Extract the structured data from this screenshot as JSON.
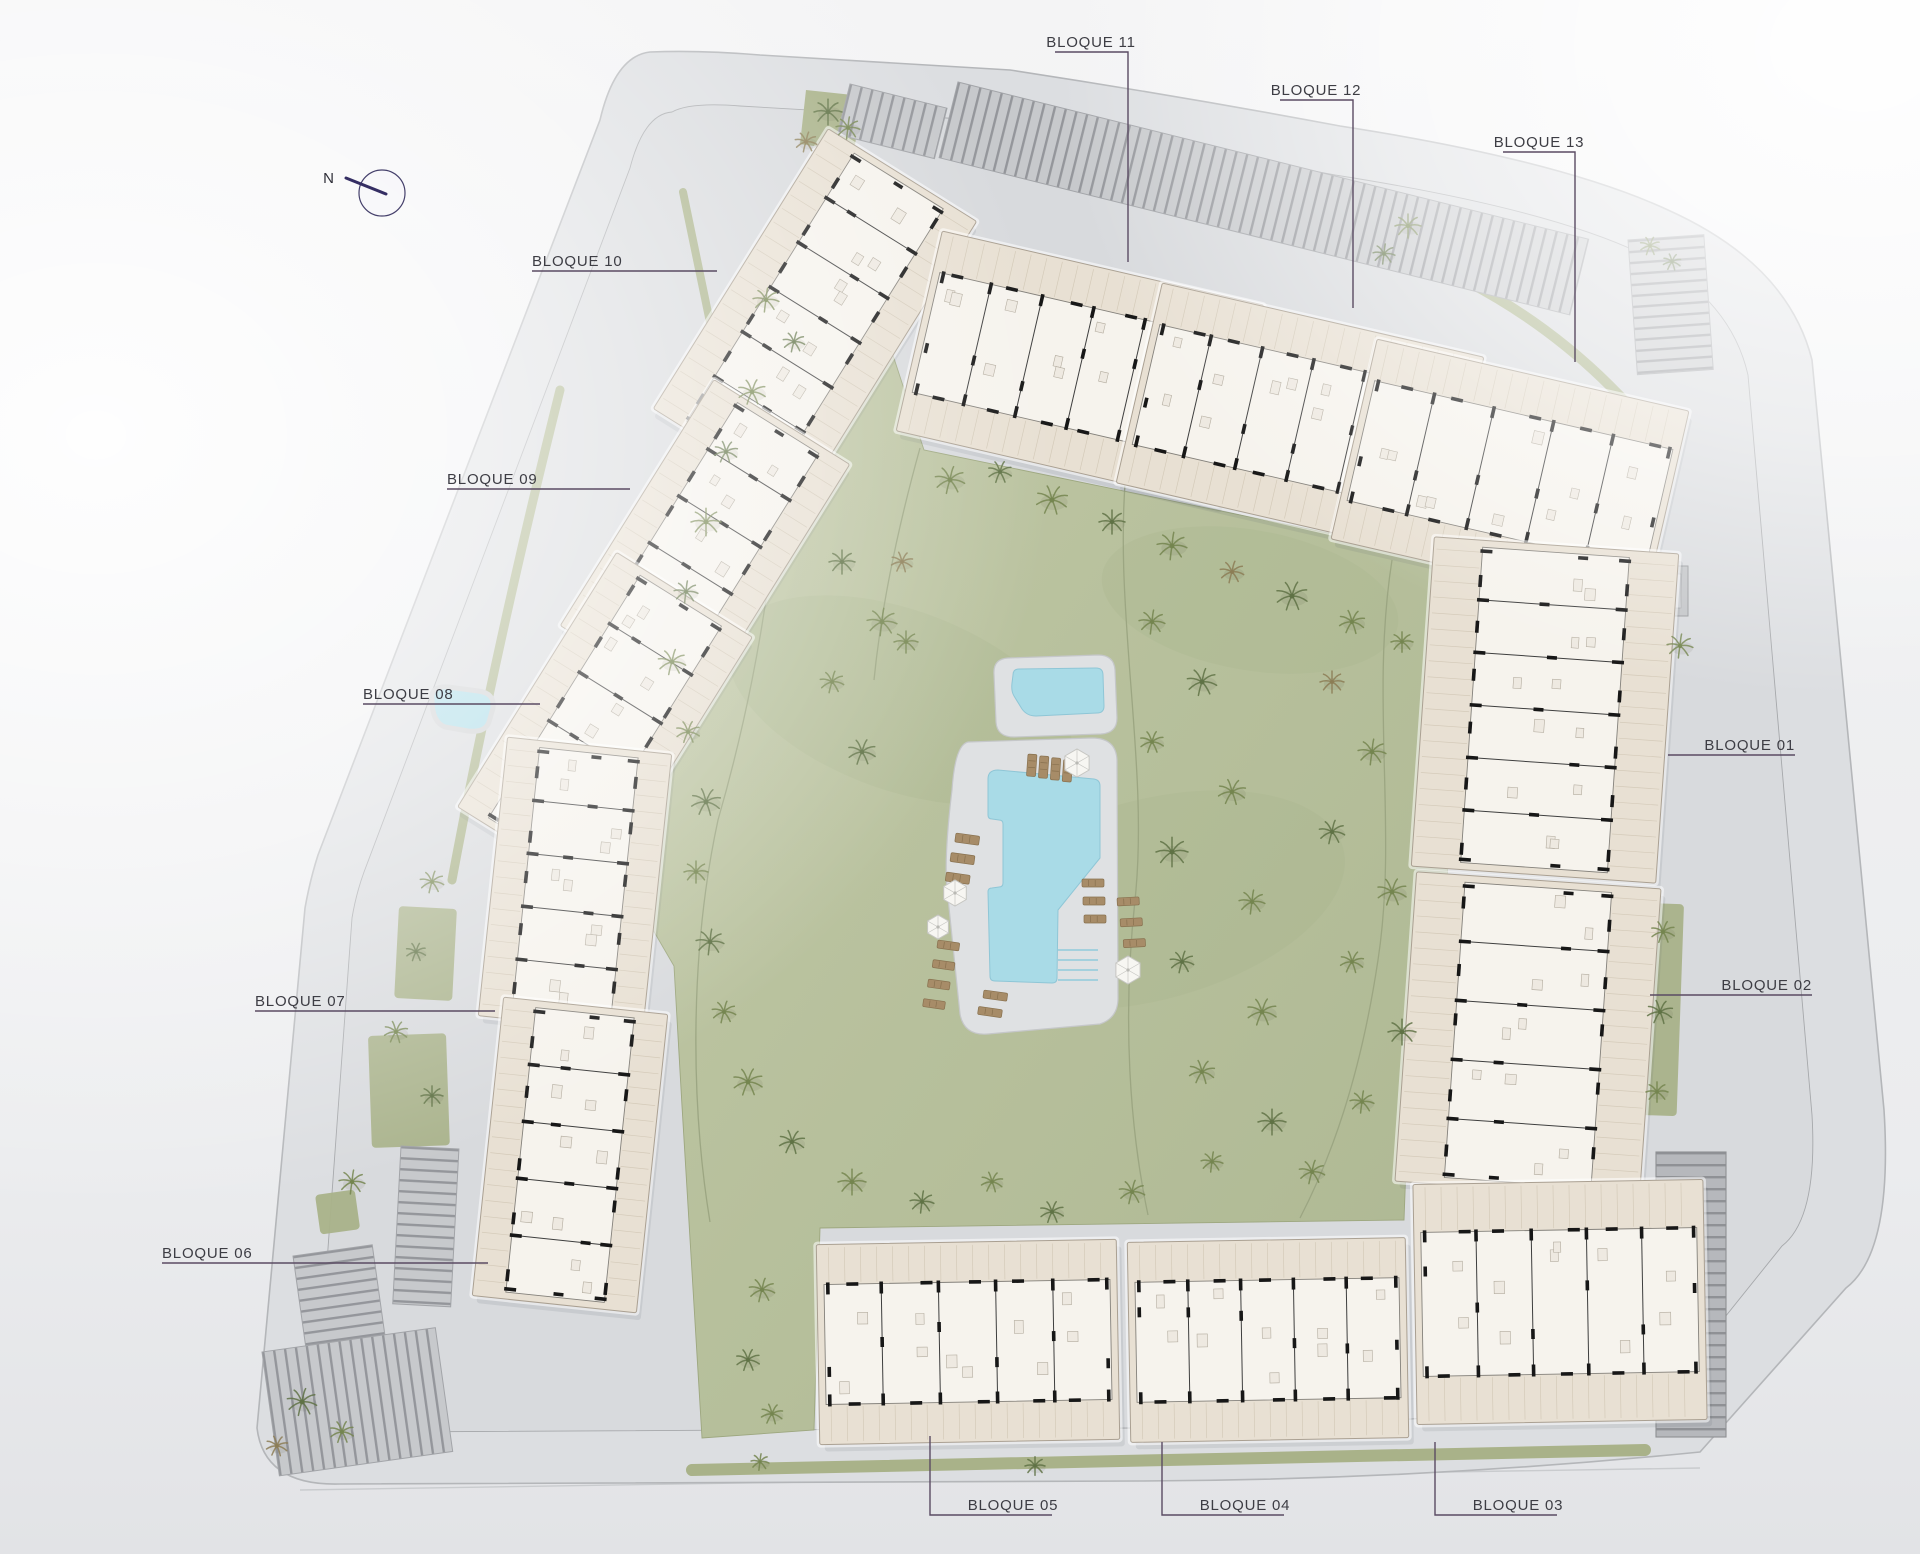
{
  "meta": {
    "type": "residential-site-plan",
    "blocks_total": 13
  },
  "compass": {
    "label": "N",
    "cx": 382,
    "cy": 193,
    "r": 23,
    "needle": [
      346,
      178,
      386,
      194
    ],
    "label_x": 334,
    "label_y": 183
  },
  "colors": {
    "bg_top": "#f4f4f5",
    "bg_bottom": "#e2e3e6",
    "road": "#dcdee1",
    "road_edge": "#b4b6b9",
    "parcel": "#d8dadd",
    "parcel_edge": "#a6a8ab",
    "lawn1": "#c2c9a8",
    "lawn2": "#aeb893",
    "lawn_edge": "#9da77f",
    "lawn_path": "#99a37f",
    "water": "#a9dbe7",
    "water_edge": "#8fc6d6",
    "deck": "#dfe1e3",
    "deck_edge": "#c5c7c9",
    "slab": "#e8e0d3",
    "slab_edge": "#aaa092",
    "core": "#f6f3ed",
    "core_edge": "#84817b",
    "wall": "#171717",
    "divider": "#3e3e3e",
    "furn": "#b3ac9f",
    "hatch": "#d4cab9",
    "stripe_bg": "#c7c9cc",
    "stripe": "#94969b",
    "ramp_bg": "#b6b8bc",
    "ramp_line": "#8f9195",
    "green_strip": "#a9b289",
    "tree_g": "#74854f",
    "tree_d": "#5f7245",
    "tree_b": "#8c7d55",
    "leader": "#5a4b63",
    "label_text": "#3d3d44",
    "lounger": "#a78c68",
    "lounger_edge": "#88714f",
    "umbrella": "#f7f6f2",
    "umbrella_edge": "#c6c6c2",
    "compass_ring": "#45406b",
    "compass_needle": "#352e63"
  },
  "site": {
    "outer_path": "M650,52 Q700,50 760,55 L1010,70 Q1180,96 1340,126 Q1560,160 1668,210 Q1788,264 1812,360 L1884,1110 Q1893,1252 1846,1288 L1700,1452 Q1420,1480 1140,1481 L340,1484 Q264,1486 257,1428 L305,908 Q310,880 318,855 L600,120 Q615,56 650,52 Z",
    "inner_path": "M672,112 Q690,102 740,106 L1015,122 Q1180,146 1335,175 Q1545,208 1640,253 Q1730,296 1748,375 L1812,1115 Q1818,1218 1782,1246 L1660,1398 Q1408,1426 1136,1428 L382,1432 Q322,1434 318,1386 L352,918 Q356,894 364,872 L630,168 Q644,114 672,112 Z",
    "lawn_path": "M762,250 L808,242 Q850,290 888,340 L924,450 L1450,558 Q1460,568 1458,592 L1444,964 L1412,1006 L1404,1220 L820,1228 L814,1430 L702,1438 L682,1106 L674,966 L624,880 L662,762 L702,642 L742,522 L792,402 L782,302 Z",
    "bottom_edge_line": "M300,1490 L1700,1468"
  },
  "lawn_paths": [
    "M766,262 C800,420 770,640 718,820 C690,950 690,1100 710,1222",
    "M1128,452 C1110,600 1150,760 1135,900 C1122,1020 1130,1130 1148,1215",
    "M1392,560 C1370,700 1398,830 1378,960 C1360,1080 1330,1160 1300,1218",
    "M920,448 C900,520 882,600 874,680"
  ],
  "mounds": [
    [
      900,
      700,
      180,
      90,
      20
    ],
    [
      1150,
      900,
      200,
      100,
      -15
    ],
    [
      1250,
      600,
      150,
      70,
      10
    ]
  ],
  "labels": [
    {
      "id": "b10",
      "text": "BLOQUE 10",
      "tx": 532,
      "ty": 266,
      "anchor": "start",
      "line": [
        [
          532,
          271
        ],
        [
          717,
          271
        ]
      ]
    },
    {
      "id": "b09",
      "text": "BLOQUE 09",
      "tx": 447,
      "ty": 484,
      "anchor": "start",
      "line": [
        [
          447,
          489
        ],
        [
          630,
          489
        ]
      ]
    },
    {
      "id": "b08",
      "text": "BLOQUE 08",
      "tx": 363,
      "ty": 699,
      "anchor": "start",
      "line": [
        [
          363,
          704
        ],
        [
          540,
          704
        ]
      ]
    },
    {
      "id": "b07",
      "text": "BLOQUE 07",
      "tx": 255,
      "ty": 1006,
      "anchor": "start",
      "line": [
        [
          255,
          1011
        ],
        [
          495,
          1011
        ]
      ]
    },
    {
      "id": "b06",
      "text": "BLOQUE 06",
      "tx": 162,
      "ty": 1258,
      "anchor": "start",
      "line": [
        [
          162,
          1263
        ],
        [
          488,
          1263
        ]
      ]
    },
    {
      "id": "b01",
      "text": "BLOQUE 01",
      "tx": 1795,
      "ty": 750,
      "anchor": "end",
      "line": [
        [
          1668,
          755
        ],
        [
          1795,
          755
        ]
      ]
    },
    {
      "id": "b02",
      "text": "BLOQUE 02",
      "tx": 1812,
      "ty": 990,
      "anchor": "end",
      "line": [
        [
          1650,
          995
        ],
        [
          1812,
          995
        ]
      ]
    },
    {
      "id": "b11",
      "text": "BLOQUE 11",
      "tx": 1091,
      "ty": 47,
      "anchor": "middle",
      "line": [
        [
          1055,
          52
        ],
        [
          1128,
          52
        ],
        [
          1128,
          262
        ]
      ]
    },
    {
      "id": "b12",
      "text": "BLOQUE 12",
      "tx": 1316,
      "ty": 95,
      "anchor": "middle",
      "line": [
        [
          1280,
          100
        ],
        [
          1353,
          100
        ],
        [
          1353,
          308
        ]
      ]
    },
    {
      "id": "b13",
      "text": "BLOQUE 13",
      "tx": 1539,
      "ty": 147,
      "anchor": "middle",
      "line": [
        [
          1503,
          152
        ],
        [
          1575,
          152
        ],
        [
          1575,
          362
        ]
      ]
    },
    {
      "id": "b05",
      "text": "BLOQUE 05",
      "tx": 1013,
      "ty": 1510,
      "anchor": "middle",
      "line": [
        [
          930,
          1436
        ],
        [
          930,
          1515
        ],
        [
          1052,
          1515
        ]
      ]
    },
    {
      "id": "b04",
      "text": "BLOQUE 04",
      "tx": 1245,
      "ty": 1510,
      "anchor": "middle",
      "line": [
        [
          1162,
          1442
        ],
        [
          1162,
          1515
        ],
        [
          1284,
          1515
        ]
      ]
    },
    {
      "id": "b03",
      "text": "BLOQUE 03",
      "tx": 1518,
      "ty": 1510,
      "anchor": "middle",
      "line": [
        [
          1435,
          1442
        ],
        [
          1435,
          1515
        ],
        [
          1557,
          1515
        ]
      ]
    }
  ],
  "blocks": [
    {
      "id": "10",
      "cx": 815,
      "cy": 315,
      "w": 175,
      "h": 330,
      "rot": 32
    },
    {
      "id": "09",
      "cx": 705,
      "cy": 545,
      "w": 160,
      "h": 290,
      "rot": 32
    },
    {
      "id": "08",
      "cx": 605,
      "cy": 722,
      "w": 160,
      "h": 300,
      "rot": 32
    },
    {
      "id": "07",
      "cx": 575,
      "cy": 885,
      "w": 165,
      "h": 280,
      "rot": 6
    },
    {
      "id": "06",
      "cx": 570,
      "cy": 1155,
      "w": 165,
      "h": 300,
      "rot": 6
    },
    {
      "id": "11",
      "cx": 1080,
      "cy": 368,
      "w": 330,
      "h": 205,
      "rot": 13
    },
    {
      "id": "12",
      "cx": 1300,
      "cy": 420,
      "w": 330,
      "h": 205,
      "rot": 13
    },
    {
      "id": "13",
      "cx": 1510,
      "cy": 475,
      "w": 320,
      "h": 205,
      "rot": 13
    },
    {
      "id": "01",
      "cx": 1545,
      "cy": 710,
      "w": 245,
      "h": 330,
      "rot": 4
    },
    {
      "id": "02",
      "cx": 1528,
      "cy": 1035,
      "w": 245,
      "h": 310,
      "rot": 4
    },
    {
      "id": "05",
      "cx": 968,
      "cy": 1342,
      "w": 300,
      "h": 200,
      "rot": -1
    },
    {
      "id": "04",
      "cx": 1268,
      "cy": 1340,
      "w": 278,
      "h": 200,
      "rot": -1
    },
    {
      "id": "03",
      "cx": 1560,
      "cy": 1302,
      "w": 290,
      "h": 240,
      "rot": -1
    }
  ],
  "parking": [
    {
      "x": 958,
      "y": 82,
      "rot": 14,
      "w": 650,
      "h": 78,
      "o": "v"
    },
    {
      "x": 850,
      "y": 84,
      "rot": 14,
      "w": 100,
      "h": 52,
      "o": "v"
    },
    {
      "x": 1628,
      "y": 240,
      "rot": -4,
      "w": 76,
      "h": 135,
      "o": "h"
    },
    {
      "x": 401,
      "y": 1146,
      "rot": 3,
      "w": 58,
      "h": 158,
      "o": "h"
    },
    {
      "x": 293,
      "y": 1256,
      "rot": -8,
      "w": 80,
      "h": 95,
      "o": "h"
    },
    {
      "x": 262,
      "y": 1352,
      "rot": -8,
      "w": 175,
      "h": 125,
      "o": "v"
    }
  ],
  "ramp": {
    "x": 1656,
    "y": 1152,
    "w": 70,
    "h": 285
  },
  "trafo": {
    "x": 1652,
    "y": 566,
    "w": 36,
    "h": 50
  },
  "greens": {
    "rects": [
      [
        399,
        906,
        58,
        92,
        3
      ],
      [
        368,
        1036,
        78,
        112,
        -2
      ],
      [
        1646,
        903,
        38,
        212,
        2
      ],
      [
        315,
        1195,
        40,
        40,
        -8
      ]
    ],
    "polys": [
      "M806,90 L862,96 L854,152 L800,144 Z"
    ],
    "strokes": [
      {
        "d": "M692,1470 L1645,1450",
        "w": 12
      },
      {
        "d": "M1368,240 Q1540,296 1652,432",
        "w": 10
      },
      {
        "d": "M683,192 L712,332",
        "w": 8
      },
      {
        "d": "M560,390 Q495,650 452,880",
        "w": 9
      }
    ]
  },
  "pond": "M432,700 Q430,686 448,687 L478,691 Q495,693 493,708 L489,722 Q485,733 468,731 L445,727 Q432,722 432,700 Z",
  "pools": {
    "kids_deck": "M1008,658 L1098,655 Q1114,655 1115,670 L1117,718 Q1117,733 1101,734 L1014,737 Q997,737 996,722 L994,674 Q993,659 1008,658 Z",
    "kids_water": "M1019,669 L1096,668 Q1103,668 1103,675 L1104,706 Q1104,713 1097,713 L1036,716 Q1027,716 1022,709 L1014,696 Q1011,691 1012,683 L1013,675 Q1013,669 1019,669 Z",
    "main_deck": "M968,742 L1092,738 Q1116,738 1117,760 L1118,998 Q1118,1018 1100,1024 L988,1034 Q964,1036 960,1014 L947,888 Q944,856 952,790 Q955,745 968,742 Z",
    "main_water": "M998,770 L1094,779 Q1100,780 1100,786 L1100,858 L1058,910 L1057,978 Q1057,983 1052,983 L995,981 Q990,981 990,976 L988,892 Q988,888 992,888 L999,887 Q1003,887 1003,883 L1003,824 Q1003,820 999,820 L992,819 Q988,819 988,815 L988,779 Q988,770 998,770 Z",
    "steps": [
      [
        1058,
        950,
        1098,
        950
      ],
      [
        1058,
        960,
        1098,
        960
      ],
      [
        1058,
        970,
        1098,
        970
      ],
      [
        1058,
        980,
        1098,
        980
      ]
    ]
  },
  "umbrellas": [
    [
      1077,
      763,
      14
    ],
    [
      955,
      893,
      13
    ],
    [
      1128,
      970,
      14
    ],
    [
      938,
      927,
      12
    ]
  ],
  "lounger_groups": [
    {
      "x": 1028,
      "y": 754,
      "rot": 4,
      "n": 4,
      "dx": 12,
      "dy": 1,
      "w": 9,
      "h": 22
    },
    {
      "x": 956,
      "y": 833,
      "rot": 8,
      "n": 3,
      "dx": -2,
      "dy": 20,
      "w": 24,
      "h": 9
    },
    {
      "x": 1082,
      "y": 879,
      "rot": 0,
      "n": 3,
      "dx": 1,
      "dy": 18,
      "w": 22,
      "h": 8
    },
    {
      "x": 1117,
      "y": 898,
      "rot": -3,
      "n": 3,
      "dx": 2,
      "dy": 21,
      "w": 22,
      "h": 8
    },
    {
      "x": 938,
      "y": 940,
      "rot": 8,
      "n": 4,
      "dx": -2,
      "dy": 20,
      "w": 22,
      "h": 8
    },
    {
      "x": 984,
      "y": 990,
      "rot": 8,
      "n": 2,
      "dx": -3,
      "dy": 17,
      "w": 24,
      "h": 8
    }
  ],
  "trees": [
    [
      828,
      112,
      14,
      "d"
    ],
    [
      848,
      128,
      12,
      "g"
    ],
    [
      806,
      142,
      11,
      "b"
    ],
    [
      1650,
      246,
      10,
      "g"
    ],
    [
      1672,
      262,
      9,
      "d"
    ],
    [
      1408,
      226,
      13,
      "g"
    ],
    [
      1384,
      254,
      11,
      "d"
    ],
    [
      950,
      480,
      15,
      "g"
    ],
    [
      1000,
      472,
      12,
      "d"
    ],
    [
      1052,
      500,
      16,
      "g"
    ],
    [
      1112,
      522,
      13,
      "d"
    ],
    [
      1172,
      546,
      15,
      "g"
    ],
    [
      1232,
      572,
      12,
      "b"
    ],
    [
      1292,
      596,
      16,
      "d"
    ],
    [
      1352,
      622,
      13,
      "g"
    ],
    [
      1402,
      642,
      11,
      "g"
    ],
    [
      766,
      300,
      13,
      "g"
    ],
    [
      794,
      342,
      11,
      "d"
    ],
    [
      752,
      392,
      14,
      "g"
    ],
    [
      726,
      452,
      12,
      "d"
    ],
    [
      706,
      522,
      15,
      "g"
    ],
    [
      686,
      592,
      12,
      "d"
    ],
    [
      672,
      662,
      14,
      "g"
    ],
    [
      688,
      732,
      12,
      "g"
    ],
    [
      706,
      802,
      15,
      "d"
    ],
    [
      696,
      872,
      12,
      "g"
    ],
    [
      710,
      942,
      14,
      "d"
    ],
    [
      724,
      1012,
      12,
      "g"
    ],
    [
      748,
      1082,
      15,
      "g"
    ],
    [
      792,
      1142,
      13,
      "d"
    ],
    [
      852,
      1182,
      14,
      "g"
    ],
    [
      922,
      1202,
      12,
      "d"
    ],
    [
      762,
      1290,
      13,
      "g"
    ],
    [
      748,
      1360,
      12,
      "d"
    ],
    [
      772,
      1414,
      11,
      "g"
    ],
    [
      842,
      562,
      13,
      "d"
    ],
    [
      882,
      622,
      15,
      "g"
    ],
    [
      832,
      682,
      12,
      "g"
    ],
    [
      862,
      752,
      14,
      "d"
    ],
    [
      902,
      562,
      11,
      "b"
    ],
    [
      906,
      642,
      12,
      "g"
    ],
    [
      1152,
      622,
      13,
      "g"
    ],
    [
      1202,
      682,
      15,
      "d"
    ],
    [
      1152,
      742,
      12,
      "g"
    ],
    [
      1232,
      792,
      14,
      "g"
    ],
    [
      1172,
      852,
      16,
      "d"
    ],
    [
      1252,
      902,
      13,
      "g"
    ],
    [
      1182,
      962,
      12,
      "d"
    ],
    [
      1262,
      1012,
      15,
      "g"
    ],
    [
      1202,
      1072,
      13,
      "g"
    ],
    [
      1272,
      1122,
      14,
      "d"
    ],
    [
      1212,
      1162,
      11,
      "g"
    ],
    [
      1132,
      1192,
      13,
      "g"
    ],
    [
      1052,
      1212,
      12,
      "d"
    ],
    [
      992,
      1182,
      11,
      "g"
    ],
    [
      1332,
      682,
      12,
      "b"
    ],
    [
      1372,
      752,
      14,
      "g"
    ],
    [
      1332,
      832,
      13,
      "d"
    ],
    [
      1392,
      892,
      15,
      "g"
    ],
    [
      1352,
      962,
      12,
      "g"
    ],
    [
      1402,
      1032,
      14,
      "d"
    ],
    [
      1362,
      1102,
      12,
      "g"
    ],
    [
      1312,
      1172,
      13,
      "g"
    ],
    [
      1663,
      932,
      12,
      "g"
    ],
    [
      1660,
      1012,
      13,
      "d"
    ],
    [
      1657,
      1092,
      11,
      "g"
    ],
    [
      1680,
      646,
      13,
      "g"
    ],
    [
      432,
      882,
      12,
      "g"
    ],
    [
      416,
      952,
      10,
      "d"
    ],
    [
      396,
      1032,
      12,
      "g"
    ],
    [
      432,
      1096,
      11,
      "d"
    ],
    [
      352,
      1182,
      13,
      "g"
    ],
    [
      302,
      1402,
      15,
      "d"
    ],
    [
      342,
      1432,
      12,
      "g"
    ],
    [
      277,
      1446,
      11,
      "b"
    ],
    [
      1035,
      1466,
      10,
      "d"
    ],
    [
      760,
      1462,
      9,
      "g"
    ]
  ]
}
